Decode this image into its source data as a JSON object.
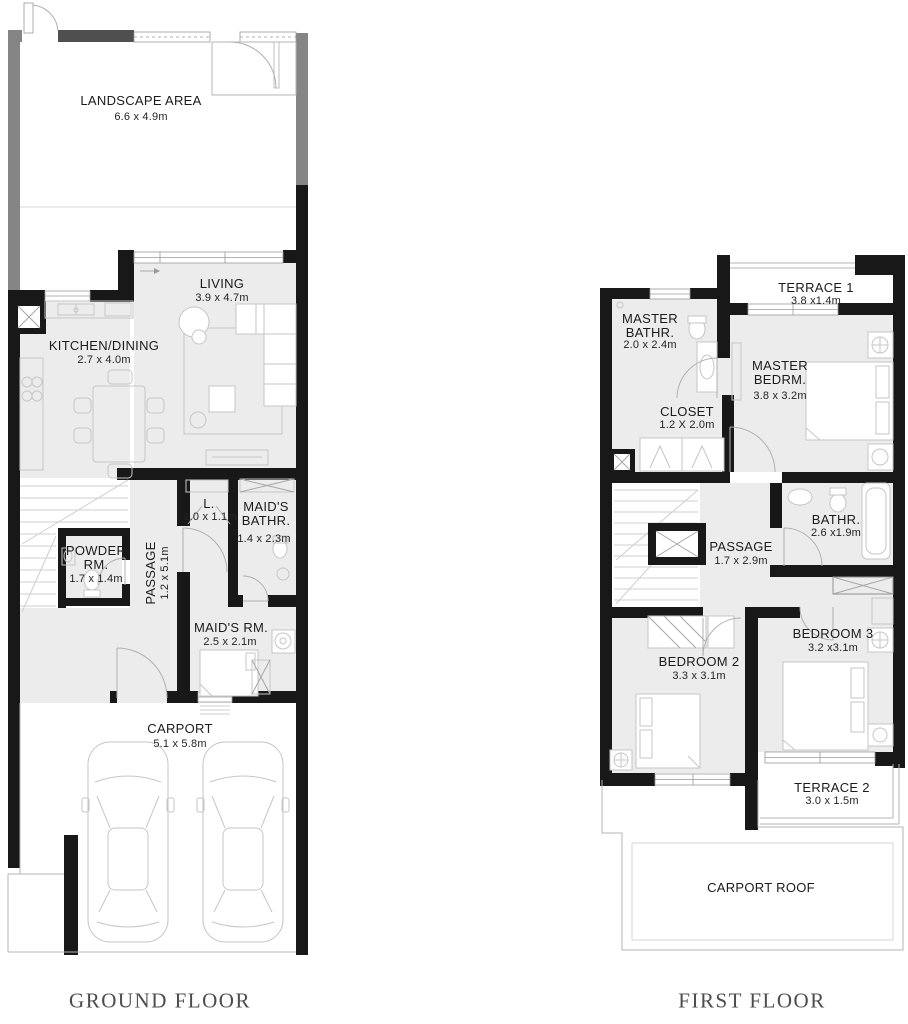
{
  "colors": {
    "background": "#ffffff",
    "wall": "#181818",
    "boundary": "#858585",
    "boundary_dark": "#4f4f4f",
    "room_fill": "#ececec",
    "furniture_line": "#c6c6c6",
    "thin_line": "#b5b5b5",
    "window_line": "#9a9a9a",
    "label_text": "#1b1b1b",
    "title_text": "#4c4c4c"
  },
  "floors": [
    {
      "id": "ground-floor",
      "title": "GROUND FLOOR",
      "rooms": [
        {
          "key": "landscape-area",
          "name": "LANDSCAPE AREA",
          "dims": "6.6 x 4.9m"
        },
        {
          "key": "living",
          "name": "LIVING",
          "dims": "3.9 x 4.7m"
        },
        {
          "key": "kitchen-dining",
          "name": "KITCHEN/DINING",
          "dims": "2.7 x 4.0m"
        },
        {
          "key": "powder-room",
          "name": "POWDER RM.",
          "dims": "1.7 x 1.4m"
        },
        {
          "key": "passage",
          "name": "PASSAGE",
          "dims": "1.2 x 5.1m"
        },
        {
          "key": "laundry-closet",
          "name": "L.",
          "dims": "1.0 x 1.1m"
        },
        {
          "key": "maids-bathroom",
          "name": "MAID'S BATHR.",
          "dims": "1.4 x 2.3m"
        },
        {
          "key": "maids-room",
          "name": "MAID'S RM.",
          "dims": "2.5 x 2.1m"
        },
        {
          "key": "carport",
          "name": "CARPORT",
          "dims": "5.1 x 5.8m"
        }
      ]
    },
    {
      "id": "first-floor",
      "title": "FIRST FLOOR",
      "rooms": [
        {
          "key": "terrace-1",
          "name": "TERRACE 1",
          "dims": "3.8 x1.4m"
        },
        {
          "key": "master-bathroom",
          "name": "MASTER BATHR.",
          "dims": "2.0 x 2.4m"
        },
        {
          "key": "master-bedroom",
          "name": "MASTER BEDRM.",
          "dims": "3.8 x 3.2m"
        },
        {
          "key": "closet",
          "name": "CLOSET",
          "dims": "1.2 X 2.0m"
        },
        {
          "key": "passage",
          "name": "PASSAGE",
          "dims": "1.7 x 2.9m"
        },
        {
          "key": "bathroom",
          "name": "BATHR.",
          "dims": "2.6 x1.9m"
        },
        {
          "key": "bedroom-3",
          "name": "BEDROOM 3",
          "dims": "3.2 x3.1m"
        },
        {
          "key": "bedroom-2",
          "name": "BEDROOM 2",
          "dims": "3.3 x 3.1m"
        },
        {
          "key": "terrace-2",
          "name": "TERRACE 2",
          "dims": "3.0 x 1.5m"
        },
        {
          "key": "carport-roof",
          "name": "CARPORT ROOF",
          "dims": ""
        }
      ]
    }
  ]
}
